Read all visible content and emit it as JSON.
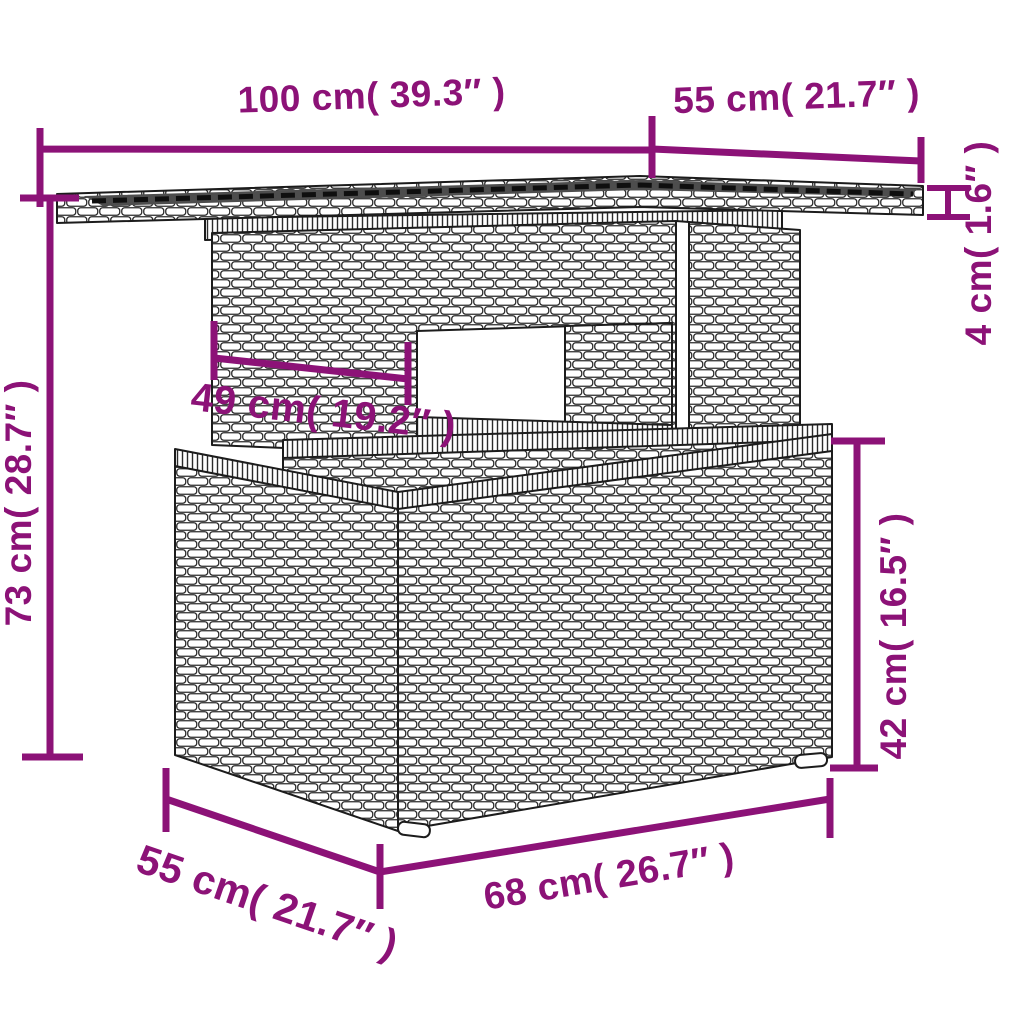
{
  "diagram": {
    "type": "product-dimension-diagram",
    "colors": {
      "accent": "#8C1277",
      "outline": "#1c1c1c",
      "glass": "#4d4d4d",
      "background": "#ffffff"
    },
    "dims": [
      {
        "id": "tabletop-length",
        "label": "100 cm( 39.3″ )",
        "cm": 100,
        "inch": 39.3
      },
      {
        "id": "tabletop-depth",
        "label": "55 cm( 21.7″ )",
        "cm": 55,
        "inch": 21.7
      },
      {
        "id": "tabletop-thickness",
        "label": "4 cm( 1.6″ )",
        "cm": 4,
        "inch": 1.6
      },
      {
        "id": "overall-height",
        "label": "73 cm( 28.7″ )",
        "cm": 73,
        "inch": 28.7
      },
      {
        "id": "pedestal-width",
        "label": "49 cm( 19.2″ )",
        "cm": 49,
        "inch": 19.2
      },
      {
        "id": "base-height",
        "label": "42 cm( 16.5″ )",
        "cm": 42,
        "inch": 16.5
      },
      {
        "id": "base-depth",
        "label": "55 cm( 21.7″ )",
        "cm": 55,
        "inch": 21.7
      },
      {
        "id": "base-width",
        "label": "68 cm( 26.7″ )",
        "cm": 68,
        "inch": 26.7
      }
    ]
  }
}
